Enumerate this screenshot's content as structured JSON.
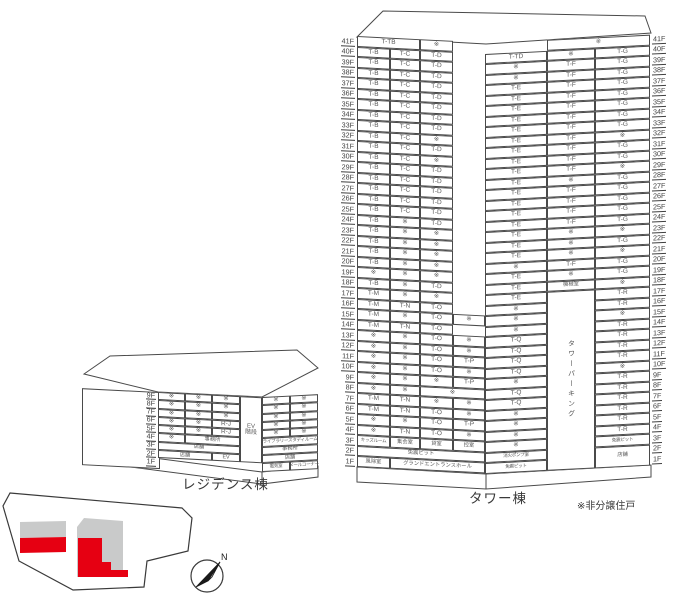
{
  "captions": {
    "residence": "レジデンス棟",
    "tower": "タワー棟",
    "note": "※非分譲住戸",
    "compass_north": "N"
  },
  "colors": {
    "red": "#e60012",
    "gray": "#c9caca",
    "line": "#4a4a4a"
  },
  "tower": {
    "floor_labels": [
      "41F",
      "40F",
      "39F",
      "38F",
      "37F",
      "36F",
      "35F",
      "34F",
      "33F",
      "32F",
      "31F",
      "30F",
      "29F",
      "28F",
      "27F",
      "26F",
      "25F",
      "24F",
      "23F",
      "22F",
      "21F",
      "20F",
      "19F",
      "18F",
      "17F",
      "16F",
      "15F",
      "14F",
      "13F",
      "12F",
      "11F",
      "10F",
      "9F",
      "8F",
      "7F",
      "6F",
      "5F",
      "4F",
      "3F",
      "2F",
      "1F"
    ],
    "row_h": 10.5,
    "left_face": {
      "cols": [
        33,
        30,
        33,
        32
      ],
      "rows": [
        [
          {
            "t": "T-TB",
            "s": 2
          },
          {
            "t": "※"
          }
        ],
        [
          {
            "t": "T-B"
          },
          {
            "t": "T-C"
          },
          {
            "t": "T-D"
          }
        ],
        [
          {
            "t": "T-B"
          },
          {
            "t": "T-C"
          },
          {
            "t": "T-D"
          }
        ],
        [
          {
            "t": "T-B"
          },
          {
            "t": "T-C"
          },
          {
            "t": "T-D"
          }
        ],
        [
          {
            "t": "T-B"
          },
          {
            "t": "T-C"
          },
          {
            "t": "T-D"
          }
        ],
        [
          {
            "t": "T-B"
          },
          {
            "t": "T-C"
          },
          {
            "t": "T-D"
          }
        ],
        [
          {
            "t": "T-B"
          },
          {
            "t": "T-C"
          },
          {
            "t": "T-D"
          }
        ],
        [
          {
            "t": "T-B"
          },
          {
            "t": "T-C"
          },
          {
            "t": "T-D"
          }
        ],
        [
          {
            "t": "T-B"
          },
          {
            "t": "T-C"
          },
          {
            "t": "T-D"
          }
        ],
        [
          {
            "t": "T-B"
          },
          {
            "t": "T-C"
          },
          {
            "t": "※"
          }
        ],
        [
          {
            "t": "T-B"
          },
          {
            "t": "T-C"
          },
          {
            "t": "T-D"
          }
        ],
        [
          {
            "t": "T-B"
          },
          {
            "t": "T-C"
          },
          {
            "t": "※"
          }
        ],
        [
          {
            "t": "T-B"
          },
          {
            "t": "T-C"
          },
          {
            "t": "T-D"
          }
        ],
        [
          {
            "t": "T-B"
          },
          {
            "t": "T-C"
          },
          {
            "t": "T-D"
          }
        ],
        [
          {
            "t": "T-B"
          },
          {
            "t": "T-C"
          },
          {
            "t": "T-D"
          }
        ],
        [
          {
            "t": "T-B"
          },
          {
            "t": "T-C"
          },
          {
            "t": "T-D"
          }
        ],
        [
          {
            "t": "T-B"
          },
          {
            "t": "T-C"
          },
          {
            "t": "T-D"
          }
        ],
        [
          {
            "t": "T-B"
          },
          {
            "t": "※"
          },
          {
            "t": "T-D"
          }
        ],
        [
          {
            "t": "T-B"
          },
          {
            "t": "※"
          },
          {
            "t": "※"
          }
        ],
        [
          {
            "t": "T-B"
          },
          {
            "t": "※"
          },
          {
            "t": "※"
          }
        ],
        [
          {
            "t": "T-B"
          },
          {
            "t": "※"
          },
          {
            "t": "※"
          }
        ],
        [
          {
            "t": "T-B"
          },
          {
            "t": "※"
          },
          {
            "t": "※"
          }
        ],
        [
          {
            "t": "※"
          },
          {
            "t": "※"
          },
          {
            "t": "※"
          }
        ],
        [
          {
            "t": "T-B"
          },
          {
            "t": "※"
          },
          {
            "t": "T-D"
          }
        ],
        [
          {
            "t": "T-M"
          },
          {
            "t": "※"
          },
          {
            "t": "※"
          }
        ],
        [
          {
            "t": "T-M"
          },
          {
            "t": "T-N"
          },
          {
            "t": "T-O"
          }
        ],
        [
          {
            "t": "T-M"
          },
          {
            "t": "※"
          },
          {
            "t": "T-O"
          },
          {
            "t": "※"
          }
        ],
        [
          {
            "t": "T-M"
          },
          {
            "t": "T-N"
          },
          {
            "t": "T-O"
          }
        ],
        [
          {
            "t": "※"
          },
          {
            "t": "※"
          },
          {
            "t": "T-O"
          },
          {
            "t": "※"
          }
        ],
        [
          {
            "t": "※"
          },
          {
            "t": "※"
          },
          {
            "t": "T-O"
          },
          {
            "t": "※"
          }
        ],
        [
          {
            "t": "※"
          },
          {
            "t": "※"
          },
          {
            "t": "T-O"
          },
          {
            "t": "T-P"
          }
        ],
        [
          {
            "t": "※"
          },
          {
            "t": "※"
          },
          {
            "t": "T-O"
          },
          {
            "t": "※"
          }
        ],
        [
          {
            "t": "※"
          },
          {
            "t": "※"
          },
          {
            "t": "※"
          },
          {
            "t": "T-P"
          }
        ],
        [
          {
            "t": "※"
          },
          {
            "t": "※"
          },
          {
            "t": "※",
            "s": 2
          }
        ],
        [
          {
            "t": "T-M"
          },
          {
            "t": "T-N"
          },
          {
            "t": "※"
          },
          {
            "t": "※"
          }
        ],
        [
          {
            "t": "T-M"
          },
          {
            "t": "T-N"
          },
          {
            "t": "T-O"
          },
          {
            "t": "※"
          }
        ],
        [
          {
            "t": "※"
          },
          {
            "t": "※"
          },
          {
            "t": "T-O"
          },
          {
            "t": "T-P"
          }
        ],
        [
          {
            "t": "※"
          },
          {
            "t": "T-N"
          },
          {
            "t": "T-O"
          },
          {
            "t": "※"
          }
        ],
        [
          {
            "t": "キッズルーム",
            "k": "xs"
          },
          {
            "t": "集会室",
            "k": "sm"
          },
          {
            "t": "貸室",
            "k": "sm"
          },
          {
            "t": "控室",
            "k": "sm"
          }
        ],
        [
          {
            "t": "免震ピット",
            "s": 4,
            "k": "sm"
          }
        ],
        [
          {
            "t": "風除室",
            "k": "sm"
          },
          {
            "t": "グランドエントランスホール",
            "s": 3,
            "k": "sm"
          }
        ]
      ]
    },
    "right_face": {
      "cols": [
        62,
        48,
        55
      ],
      "rows": [
        [
          {
            "t": "※",
            "c": 2,
            "s": 2
          }
        ],
        [
          {
            "t": "T-TD"
          },
          {
            "t": "※"
          },
          {
            "t": "T-G"
          }
        ],
        [
          {
            "t": "※"
          },
          {
            "t": "T-F"
          },
          {
            "t": "T-G"
          }
        ],
        [
          {
            "t": "※"
          },
          {
            "t": "T-F"
          },
          {
            "t": "T-G"
          }
        ],
        [
          {
            "t": "T-E"
          },
          {
            "t": "T-F"
          },
          {
            "t": "T-G"
          }
        ],
        [
          {
            "t": "T-E"
          },
          {
            "t": "T-F"
          },
          {
            "t": "T-G"
          }
        ],
        [
          {
            "t": "T-E"
          },
          {
            "t": "T-F"
          },
          {
            "t": "T-G"
          }
        ],
        [
          {
            "t": "T-E"
          },
          {
            "t": "T-F"
          },
          {
            "t": "T-G"
          }
        ],
        [
          {
            "t": "T-E"
          },
          {
            "t": "T-F"
          },
          {
            "t": "T-G"
          }
        ],
        [
          {
            "t": "T-E"
          },
          {
            "t": "T-F"
          },
          {
            "t": "※"
          }
        ],
        [
          {
            "t": "T-E"
          },
          {
            "t": "T-F"
          },
          {
            "t": "T-G"
          }
        ],
        [
          {
            "t": "T-E"
          },
          {
            "t": "T-F"
          },
          {
            "t": "T-G"
          }
        ],
        [
          {
            "t": "T-E"
          },
          {
            "t": "T-F"
          },
          {
            "t": "※"
          }
        ],
        [
          {
            "t": "T-E"
          },
          {
            "t": "※"
          },
          {
            "t": "T-G"
          }
        ],
        [
          {
            "t": "T-E"
          },
          {
            "t": "T-F"
          },
          {
            "t": "T-G"
          }
        ],
        [
          {
            "t": "T-E"
          },
          {
            "t": "T-F"
          },
          {
            "t": "T-G"
          }
        ],
        [
          {
            "t": "T-E"
          },
          {
            "t": "T-F"
          },
          {
            "t": "T-G"
          }
        ],
        [
          {
            "t": "T-E"
          },
          {
            "t": "T-F"
          },
          {
            "t": "T-G"
          }
        ],
        [
          {
            "t": "T-E"
          },
          {
            "t": "※"
          },
          {
            "t": "※"
          }
        ],
        [
          {
            "t": "T-E"
          },
          {
            "t": "※"
          },
          {
            "t": "T-G"
          }
        ],
        [
          {
            "t": "T-E"
          },
          {
            "t": "※"
          },
          {
            "t": "※"
          }
        ],
        [
          {
            "t": "※"
          },
          {
            "t": "T-F"
          },
          {
            "t": "T-G"
          }
        ],
        [
          {
            "t": "T-E"
          },
          {
            "t": "※"
          },
          {
            "t": "T-G"
          }
        ],
        [
          {
            "t": "T-E"
          },
          {
            "t": "機械室",
            "k": "sm"
          },
          {
            "t": "※"
          }
        ],
        [
          {
            "t": "T-E"
          },
          {
            "t": "タワーパーキング",
            "r": 17,
            "k": "vert"
          },
          {
            "t": "T-R"
          }
        ],
        [
          {
            "t": "※"
          },
          {
            "t": "T-R",
            "c": 3
          }
        ],
        [
          {
            "t": "※"
          },
          {
            "t": "※",
            "c": 3
          }
        ],
        [
          {
            "t": "※"
          },
          {
            "t": "T-R",
            "c": 3
          }
        ],
        [
          {
            "t": "T-Q"
          },
          {
            "t": "T-R",
            "c": 3
          }
        ],
        [
          {
            "t": "T-Q"
          },
          {
            "t": "T-R",
            "c": 3
          }
        ],
        [
          {
            "t": "T-Q"
          },
          {
            "t": "T-R",
            "c": 3
          }
        ],
        [
          {
            "t": "T-Q"
          },
          {
            "t": "※",
            "c": 3
          }
        ],
        [
          {
            "t": "※"
          },
          {
            "t": "T-R",
            "c": 3
          }
        ],
        [
          {
            "t": "T-Q"
          },
          {
            "t": "T-R",
            "c": 3
          }
        ],
        [
          {
            "t": "T-Q"
          },
          {
            "t": "T-R",
            "c": 3
          }
        ],
        [
          {
            "t": "※"
          },
          {
            "t": "T-R",
            "c": 3
          }
        ],
        [
          {
            "t": "※"
          },
          {
            "t": "T-R",
            "c": 3
          }
        ],
        [
          {
            "t": "※"
          },
          {
            "t": "T-R",
            "c": 3
          }
        ],
        [
          {
            "t": "※"
          },
          {
            "t": "免震ピット",
            "c": 3,
            "k": "xs"
          }
        ],
        [
          {
            "t": "消火ポンプ室",
            "k": "xs"
          },
          {
            "t": "店舗",
            "c": 3,
            "r": 2,
            "k": "sm"
          }
        ],
        [
          {
            "t": "免震ピット",
            "k": "xs"
          }
        ]
      ]
    }
  },
  "residence": {
    "floor_labels": [
      "9F",
      "8F",
      "7F",
      "6F",
      "5F",
      "4F",
      "3F",
      "2F",
      "1F"
    ],
    "row_h": 8.3,
    "ev_label": "EV\n階段",
    "left_face": {
      "cols": [
        27,
        27,
        28
      ],
      "rows": [
        [
          {
            "t": "※"
          },
          {
            "t": "※"
          },
          {
            "t": "※"
          }
        ],
        [
          {
            "t": "※"
          },
          {
            "t": "※"
          },
          {
            "t": "※"
          }
        ],
        [
          {
            "t": "※"
          },
          {
            "t": "※"
          },
          {
            "t": "※"
          }
        ],
        [
          {
            "t": "※"
          },
          {
            "t": "※"
          },
          {
            "t": "R-J"
          }
        ],
        [
          {
            "t": "※"
          },
          {
            "t": "※"
          },
          {
            "t": "R-J"
          }
        ],
        [
          {
            "t": "※"
          },
          {
            "t": "事務所",
            "s": 2,
            "k": "sm"
          }
        ],
        [
          {
            "t": "店舗",
            "s": 3,
            "k": "sm"
          }
        ],
        [
          {
            "t": "店舗",
            "s": 2,
            "k": "sm"
          },
          {
            "t": "EV",
            "k": "sm"
          }
        ],
        []
      ]
    },
    "right_face": {
      "cols": [
        28,
        28
      ],
      "rows": [
        [
          {
            "t": "※"
          },
          {
            "t": "※"
          }
        ],
        [
          {
            "t": "※"
          },
          {
            "t": "※"
          }
        ],
        [
          {
            "t": "※"
          },
          {
            "t": "※"
          }
        ],
        [
          {
            "t": "※"
          },
          {
            "t": "※"
          }
        ],
        [
          {
            "t": "※"
          },
          {
            "t": "※"
          }
        ],
        [
          {
            "t": "ライブラリースタディルーム",
            "s": 2,
            "k": "xs"
          }
        ],
        [
          {
            "t": "事務所",
            "s": 2,
            "k": "sm"
          }
        ],
        [
          {
            "t": "店舗",
            "s": 2,
            "k": "sm"
          }
        ],
        [
          {
            "t": "電気室",
            "k": "xs"
          },
          {
            "t": "メールコーナー",
            "k": "xs"
          }
        ]
      ]
    }
  }
}
